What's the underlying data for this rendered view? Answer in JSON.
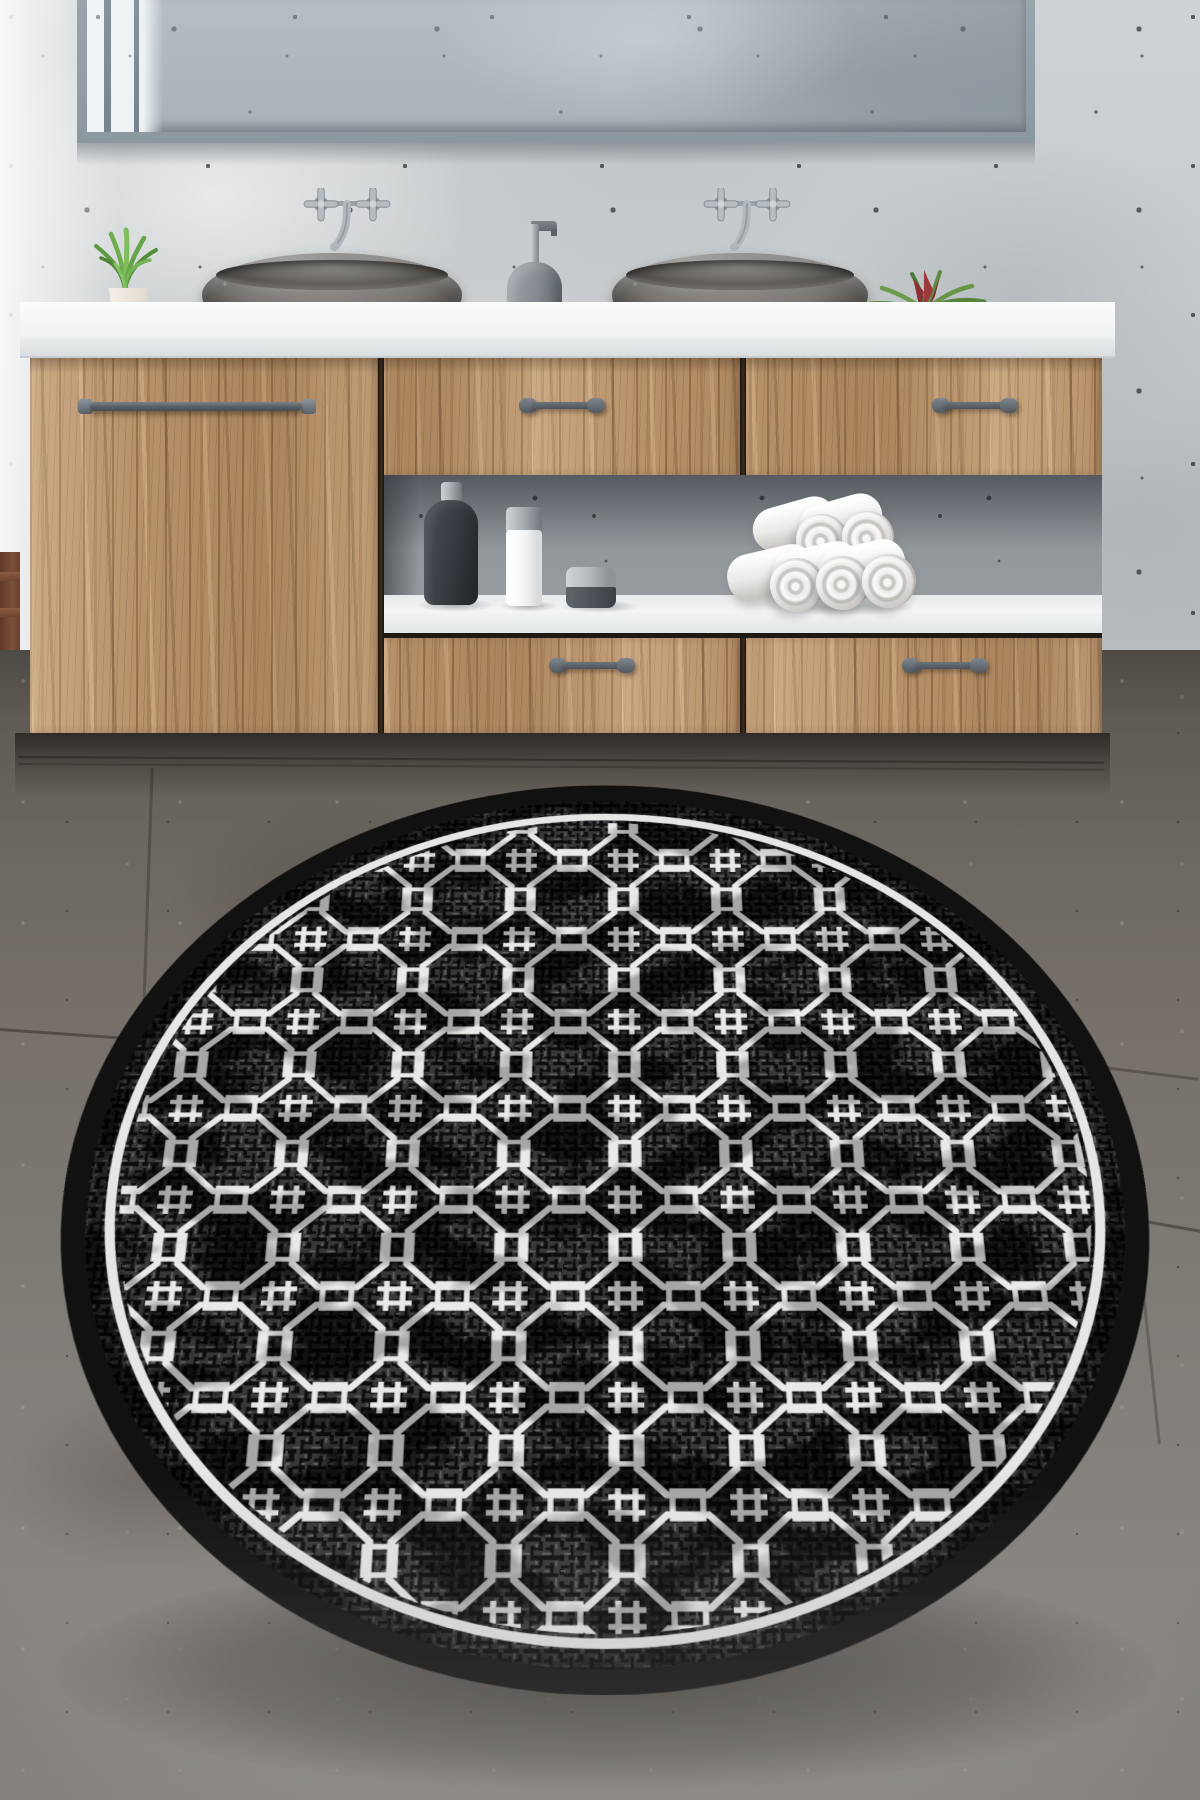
{
  "image": {
    "type": "product-photo",
    "subject": "Round black rug with white interlocking octagon trellis pattern on a dark tiled bathroom floor",
    "width_px": 1200,
    "height_px": 1800
  },
  "room": {
    "wall": {
      "material": "speckled concrete",
      "base_color": "#c8ccce",
      "bright_left_edge": true
    },
    "mirror": {
      "frame_color": "#939da5",
      "reflection": "concrete wall with bright window strip and mullions"
    },
    "vanity": {
      "countertop_color": "#f3f5f6",
      "wood_color": "#b8926a",
      "panels": [
        "tall left door",
        "upper middle drawer",
        "upper right drawer",
        "open shelf niche",
        "lower middle drawer",
        "lower right drawer"
      ],
      "handle_color": "#5a6168",
      "handle_count": 5,
      "shelf_items": [
        "dark soap bottle",
        "white bottle with steel cap",
        "small steel-lid jar",
        "five rolled white towels in a pyramid"
      ]
    },
    "sinks": {
      "count": 2,
      "style": "oval stone vessel",
      "color": "#7c7976"
    },
    "faucets": {
      "count": 2,
      "style": "wall-mounted with double cross handles",
      "finish": "brushed steel"
    },
    "decor": {
      "left_plant": "green grass in cream tapered pot",
      "right_plant": "red and green bromeliad in white cube pot",
      "between_sinks": "gray soap dispenser with steel pump"
    },
    "floor": {
      "material": "dark stone tiles",
      "base_color": "#6e6963",
      "grout_lines_visible": true,
      "depth_of_field_blur": "bottom of frame"
    },
    "chair_fragment": {
      "position": "far left edge",
      "color": "#6e4530"
    }
  },
  "rug": {
    "shape": "round",
    "placement": "foreground, seen in perspective as an ellipse",
    "binding_color": "#111112",
    "field_color": "#36383a",
    "hatch_dark": "#0d0d0e",
    "weave_highlight": "#6f7173",
    "inner_ring_color": "#e6e6e5",
    "pattern": {
      "name": "interlocking octagon trellis",
      "motif_color": "#e9e9e8",
      "elements": [
        "thick octagon outlines",
        "square link rings on octagon sides",
        "hash knots where four octagons meet"
      ]
    },
    "texture": "distressed black crosshatch weave"
  },
  "palette": {
    "wall": "#c8ccce",
    "wood": "#b8926a",
    "counter": "#f3f5f6",
    "stone_sink": "#7c7976",
    "floor": "#6e6963",
    "rug_black": "#141416",
    "rug_white": "#e9e9e8",
    "metal": "#5a6168"
  }
}
